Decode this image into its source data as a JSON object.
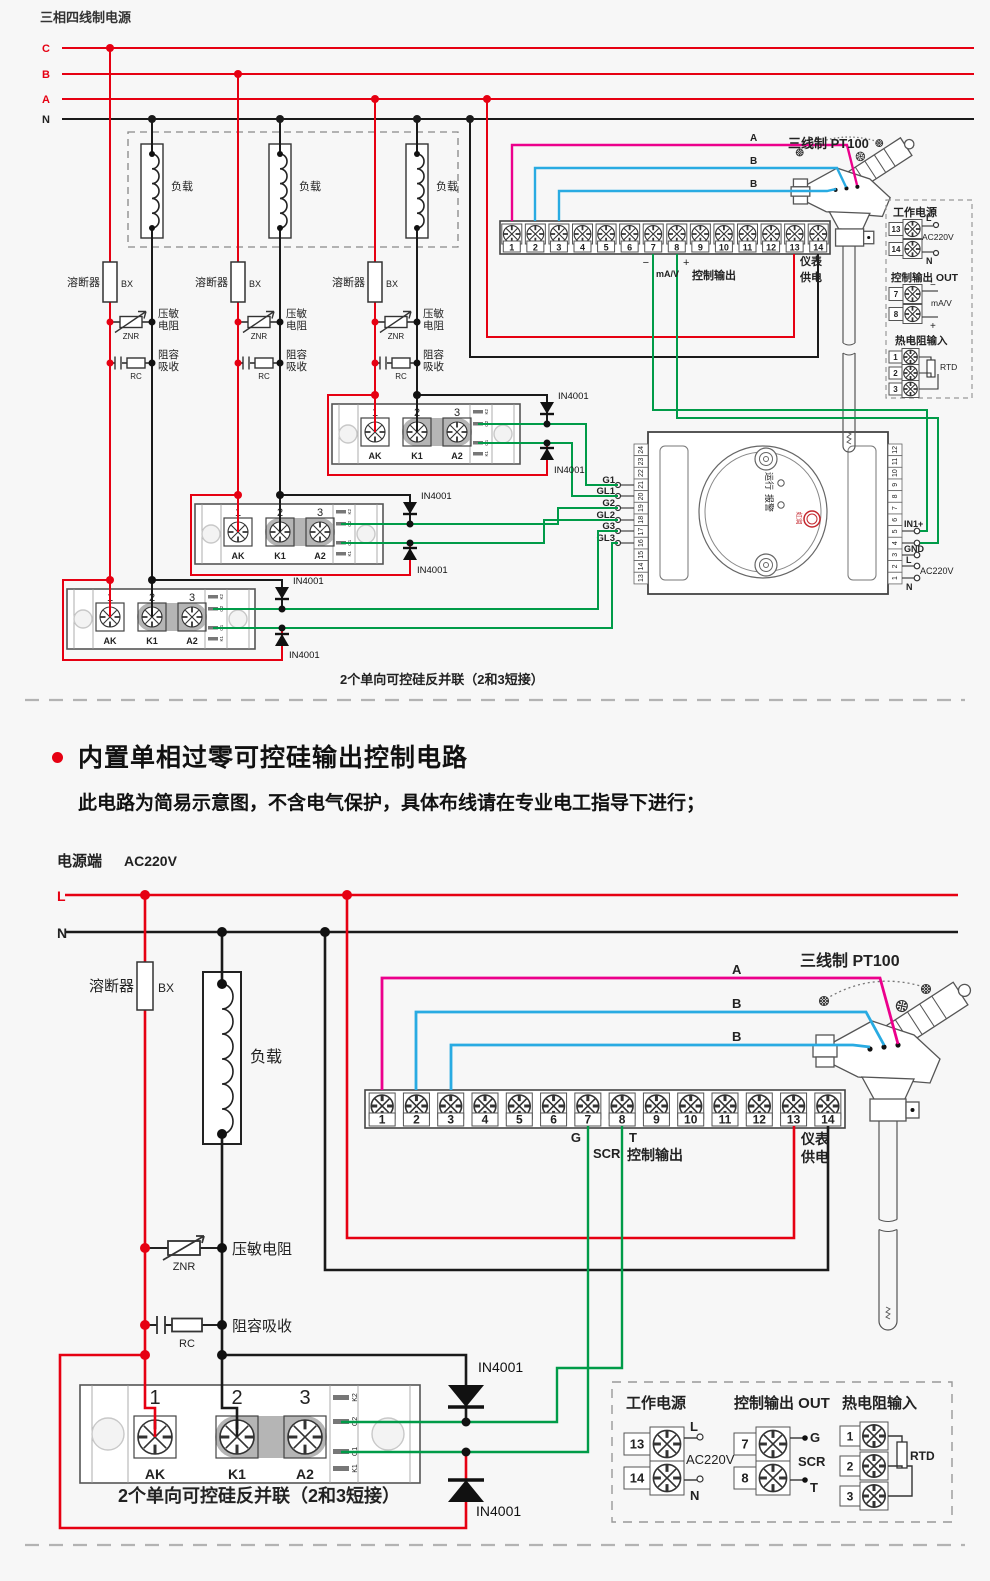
{
  "canvas": {
    "width": 990,
    "height": 1581,
    "background": "#f7f7f7"
  },
  "colors": {
    "phase_red": "#e60012",
    "neutral_black": "#1a1a1a",
    "signal_green": "#009b48",
    "sensor_a_pink": "#ec008c",
    "sensor_b_blue": "#29abe2"
  },
  "top": {
    "title": "三相四线制电源",
    "phases": [
      "C",
      "B",
      "A",
      "N"
    ],
    "load": "负载",
    "fuse": "溶断器",
    "fuse_code": "BX",
    "znr_code": "ZNR",
    "znr_line1": "压敏",
    "znr_line2": "电阻",
    "rc_code": "RC",
    "rc_line1": "阻容",
    "rc_line2": "吸收",
    "diode": "IN4001",
    "strip": {
      "terminals": [
        "1",
        "2",
        "3",
        "4",
        "5",
        "6",
        "7",
        "8",
        "9",
        "10",
        "11",
        "12",
        "13",
        "14"
      ],
      "minus": "−",
      "mav": "mA/V",
      "plus": "+",
      "ctrl": "控制输出",
      "meter1": "仪表",
      "meter2": "供电"
    },
    "sensor": {
      "title": "三线制 PT100",
      "wires": [
        "A",
        "B",
        "B"
      ]
    },
    "gates": [
      "G1",
      "GL1",
      "G2",
      "GL2",
      "G3",
      "GL3"
    ],
    "ssr": {
      "nums": [
        "1",
        "2",
        "3"
      ],
      "labels": [
        "AK",
        "K1",
        "A2"
      ],
      "side": [
        "K2",
        "G2",
        "G1",
        "K1"
      ]
    },
    "ssr_caption": "2个单向可控硅反并联（2和3短接）",
    "controller": {
      "left": [
        "24",
        "23",
        "22",
        "21",
        "20",
        "19",
        "18",
        "17",
        "16",
        "15",
        "14",
        "13"
      ],
      "right": [
        "12",
        "11",
        "10",
        "9",
        "8",
        "7",
        "6",
        "5",
        "4",
        "3",
        "2",
        "1"
      ],
      "run": "运行",
      "alarm": "报警",
      "logo": "虹润",
      "in1": "IN1+",
      "gnd": "GND",
      "l": "L",
      "n": "N",
      "ac": "AC220V"
    },
    "legend": {
      "power_title": "工作电源",
      "n13": "13",
      "n14": "14",
      "l": "L",
      "n": "N",
      "ac": "AC220V",
      "out_title": "控制输出 OUT",
      "n7": "7",
      "n8": "8",
      "minus": "−",
      "plus": "+",
      "mav": "mA/V",
      "rtd_title": "热电阻输入",
      "r1": "1",
      "r2": "2",
      "r3": "3",
      "rtd": "RTD"
    }
  },
  "section": {
    "title": "内置单相过零可控硅输出控制电路",
    "subtitle": "此电路为简易示意图，不含电气保护，具体布线请在专业电工指导下进行；"
  },
  "bottom": {
    "power_label": "电源端",
    "ac": "AC220V",
    "l": "L",
    "n": "N",
    "fuse": "溶断器",
    "fuse_code": "BX",
    "load": "负载",
    "znr_code": "ZNR",
    "znr_label": "压敏电阻",
    "rc_code": "RC",
    "rc_label": "阻容吸收",
    "diode": "IN4001",
    "strip": {
      "terminals": [
        "1",
        "2",
        "3",
        "4",
        "5",
        "6",
        "7",
        "8",
        "9",
        "10",
        "11",
        "12",
        "13",
        "14"
      ],
      "g": "G",
      "scr": "SCR",
      "t": "T",
      "ctrl": "控制输出",
      "meter1": "仪表",
      "meter2": "供电"
    },
    "sensor": {
      "title": "三线制 PT100",
      "wires": [
        "A",
        "B",
        "B"
      ]
    },
    "ssr": {
      "nums": [
        "1",
        "2",
        "3"
      ],
      "labels": [
        "AK",
        "K1",
        "A2"
      ],
      "side": [
        "K2",
        "G2",
        "G1",
        "K1"
      ]
    },
    "ssr_caption": "2个单向可控硅反并联（2和3短接）",
    "legend": {
      "power_title": "工作电源",
      "n13": "13",
      "n14": "14",
      "l": "L",
      "n": "N",
      "ac": "AC220V",
      "out_title": "控制输出 OUT",
      "n7": "7",
      "n8": "8",
      "g": "G",
      "t": "T",
      "scr": "SCR",
      "rtd_title": "热电阻输入",
      "r1": "1",
      "r2": "2",
      "r3": "3",
      "rtd": "RTD"
    }
  }
}
